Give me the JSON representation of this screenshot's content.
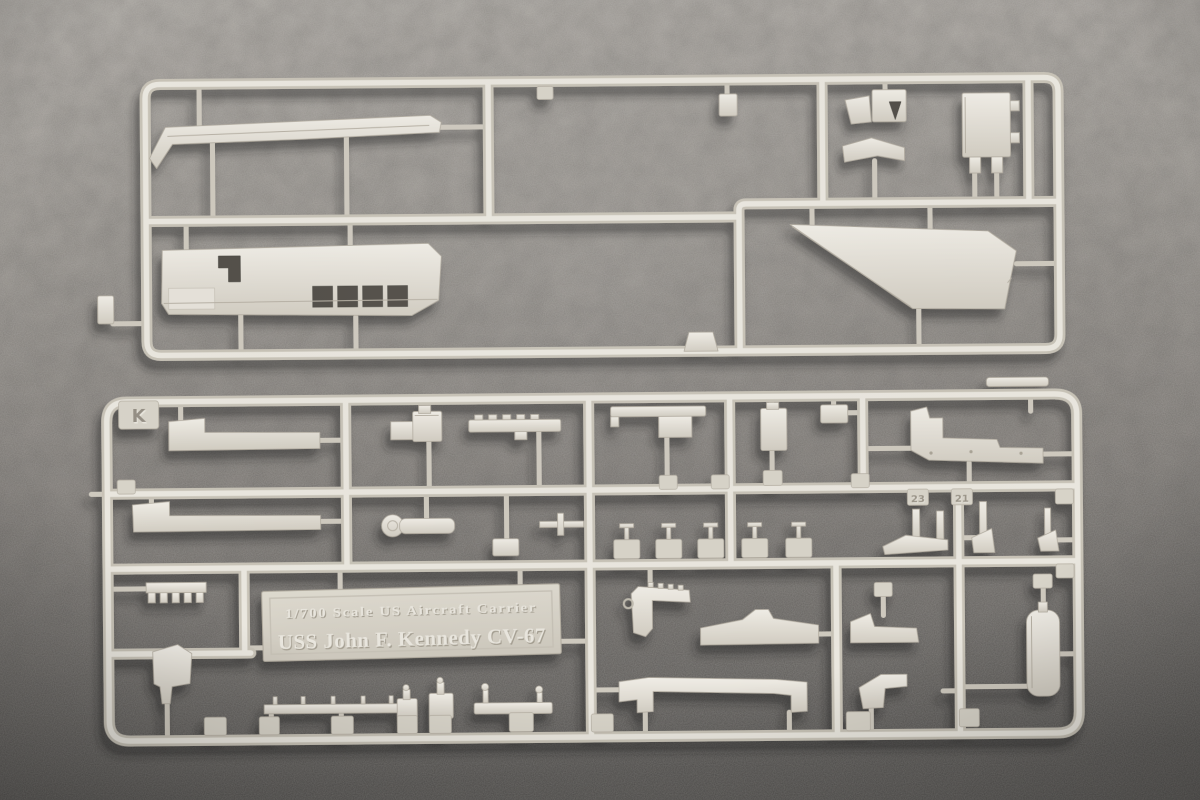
{
  "nameplate": {
    "line1": "1/700 Scale US Aircraft Carrier",
    "line2": "USS John F. Kennedy CV-67"
  },
  "sprue": {
    "letter_tab": "K",
    "visible_part_numbers": [
      "23",
      "21"
    ]
  },
  "colors": {
    "fabric_top": "#aaa6a1",
    "fabric_mid": "#8d8984",
    "fabric_bottom": "#565350",
    "plastic_light": "#f0ede6",
    "plastic_base": "#d4cfc4",
    "plastic_shadow": "#b7b1a5",
    "cutout": "#524f49"
  }
}
